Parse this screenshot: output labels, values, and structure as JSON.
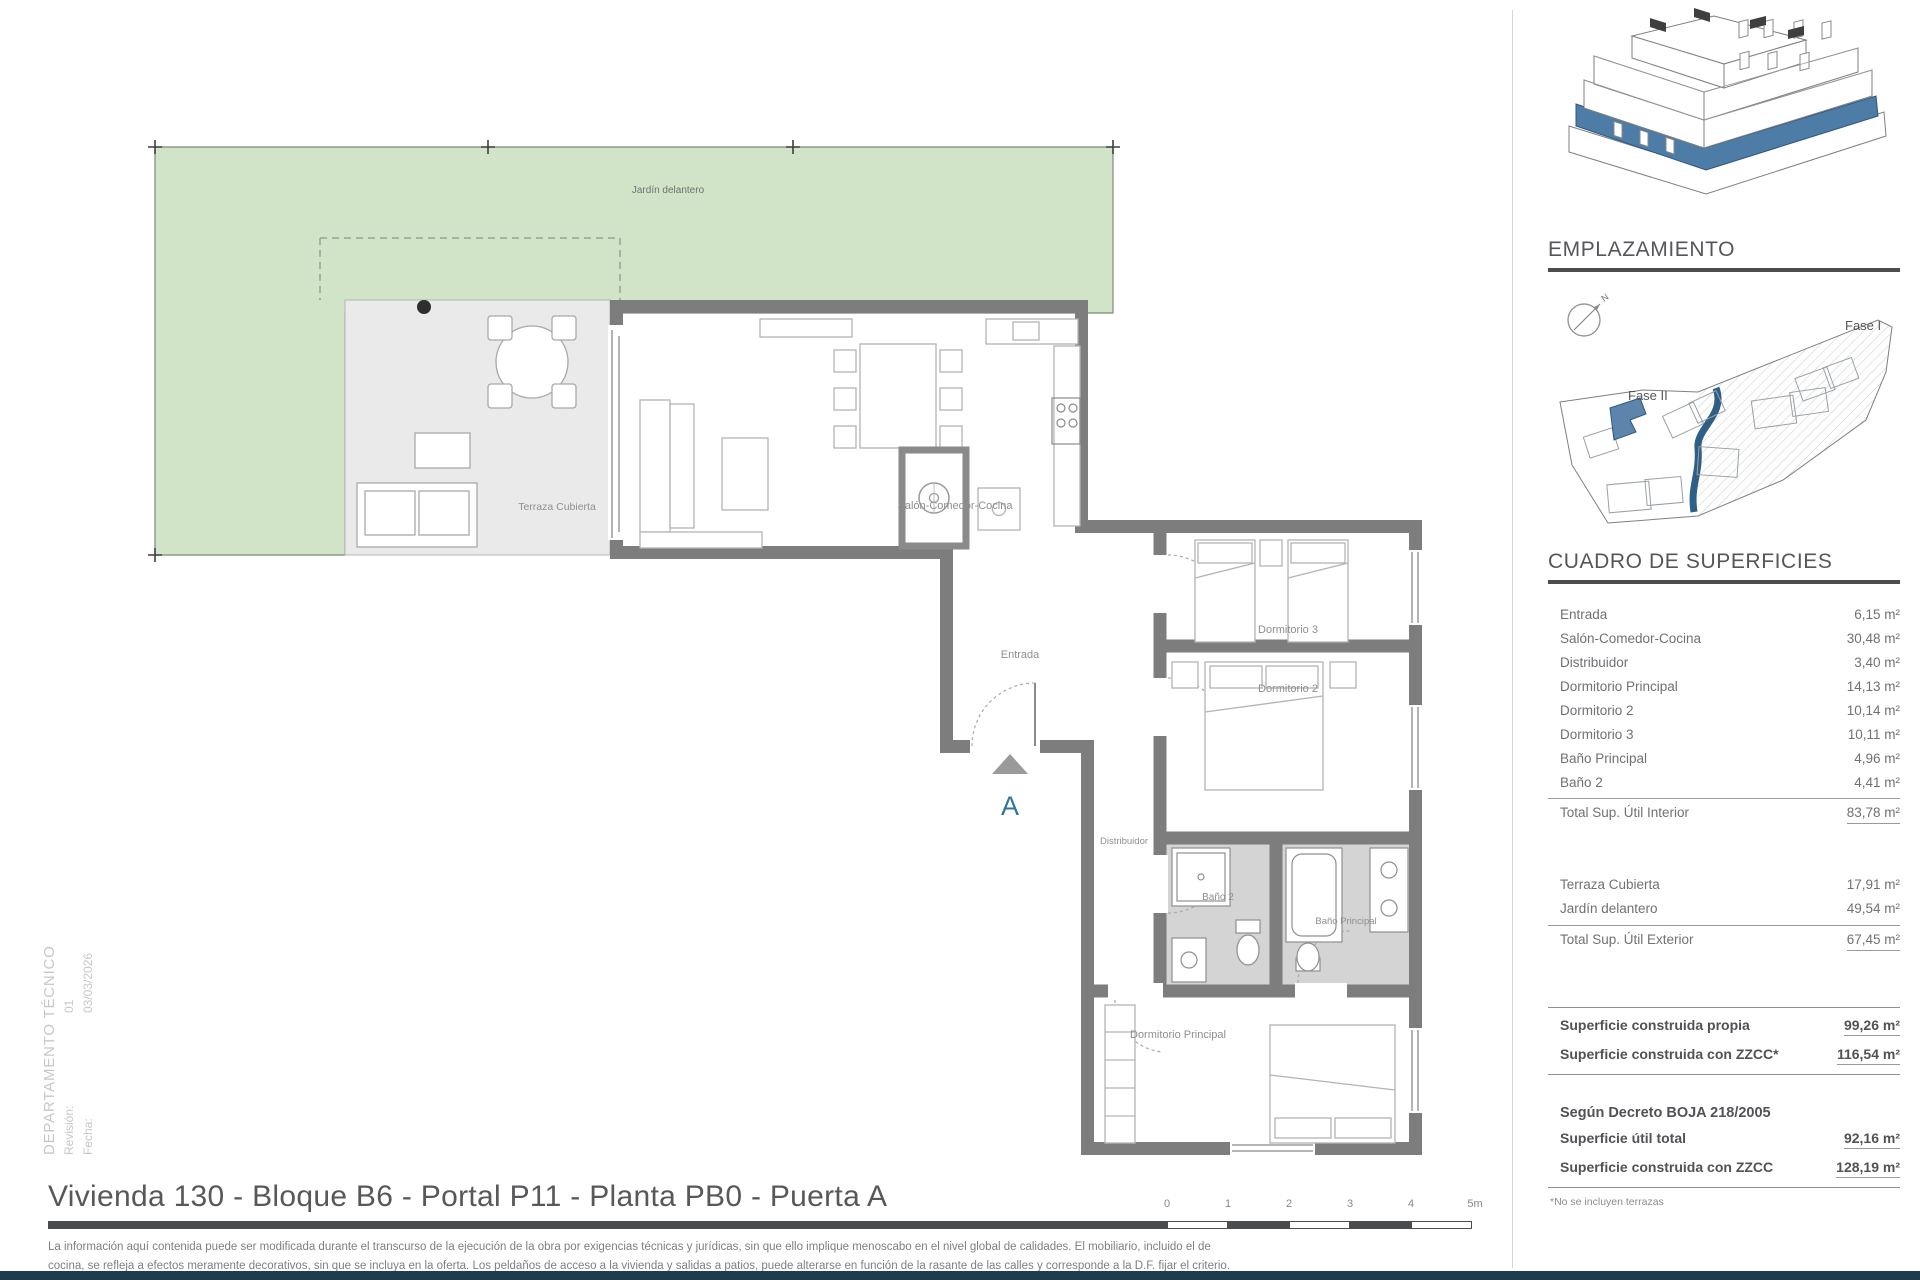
{
  "page": {
    "title": "Vivienda 130 - Bloque B6 - Portal P11 - Planta PB0 - Puerta A",
    "disclaimer_line1": "La información aquí contenida puede  ser modificada durante el transcurso de la ejecución de la obra por exigencias técnicas y jurídicas,  sin  que  ello  implique  menoscabo  en el nivel global de calidades.  El  mobiliario, incluido el de",
    "disclaimer_line2": "cocina, se refleja a efectos meramente decorativos, sin que se incluya en la oferta. Los peldaños de acceso a la vivienda y  salidas  a patios,  puede alterarse  en función de la rasante de las calles y corresponde a  la  D.F.  fijar el criterio."
  },
  "tech_block": {
    "department": "DEPARTAMENTO TÉCNICO",
    "revision_label": "Revisión:",
    "revision_value": "01",
    "date_label": "Fecha:",
    "date_value": "03/03/2026"
  },
  "floorplan": {
    "labels": {
      "jardin": "Jardín delantero",
      "terraza": "Terraza Cubierta",
      "salon": "Salón-Comedor-Cocina",
      "entrada": "Entrada",
      "dormitorio3": "Dormitorio 3",
      "dormitorio2": "Dormitorio 2",
      "distribuidor": "Distribuidor",
      "bano2": "Baño 2",
      "bano_principal": "Baño Principal",
      "dormitorio_principal": "Dormitorio Principal",
      "section_marker": "A"
    }
  },
  "emplazamiento": {
    "heading": "EMPLAZAMIENTO",
    "fase1": "Fase I",
    "fase2": "Fase II",
    "north": "N"
  },
  "superficies": {
    "heading": "CUADRO DE SUPERFICIES",
    "interior_rows": [
      {
        "label": "Entrada",
        "value": "6,15 m²"
      },
      {
        "label": "Salón-Comedor-Cocina",
        "value": "30,48 m²"
      },
      {
        "label": "Distribuidor",
        "value": "3,40 m²"
      },
      {
        "label": "Dormitorio Principal",
        "value": "14,13 m²"
      },
      {
        "label": "Dormitorio 2",
        "value": "10,14 m²"
      },
      {
        "label": "Dormitorio 3",
        "value": "10,11 m²"
      },
      {
        "label": "Baño Principal",
        "value": "4,96 m²"
      },
      {
        "label": "Baño 2",
        "value": "4,41 m²"
      }
    ],
    "interior_total": {
      "label": "Total Sup. Útil Interior",
      "value": "83,78 m²"
    },
    "exterior_rows": [
      {
        "label": "Terraza Cubierta",
        "value": "17,91 m²"
      },
      {
        "label": "Jardín delantero",
        "value": "49,54 m²"
      }
    ],
    "exterior_total": {
      "label": "Total Sup. Útil Exterior",
      "value": "67,45 m²"
    },
    "construida_rows": [
      {
        "label": "Superficie construida propia",
        "value": "99,26 m²"
      },
      {
        "label": "Superficie construida con ZZCC*",
        "value": "116,54 m²"
      }
    ],
    "decreto_heading": "Según Decreto BOJA 218/2005",
    "decreto_rows": [
      {
        "label": "Superficie útil total",
        "value": "92,16 m²"
      },
      {
        "label": "Superficie construida con ZZCC",
        "value": "128,19 m²"
      }
    ],
    "footnote": "*No se incluyen terrazas"
  },
  "scalebar": {
    "ticks": [
      "0",
      "1",
      "2",
      "3",
      "4",
      "5m"
    ]
  },
  "colors": {
    "accent_blue": "#4d7ca6",
    "road_blue": "#2d5f87",
    "wall_gray": "#7d7d7d",
    "garden_green": "#d2e4c8",
    "terrace_gray": "#eaeaea",
    "bath_gray": "#d4d4d4",
    "footer_navy": "#1d3c4e"
  }
}
